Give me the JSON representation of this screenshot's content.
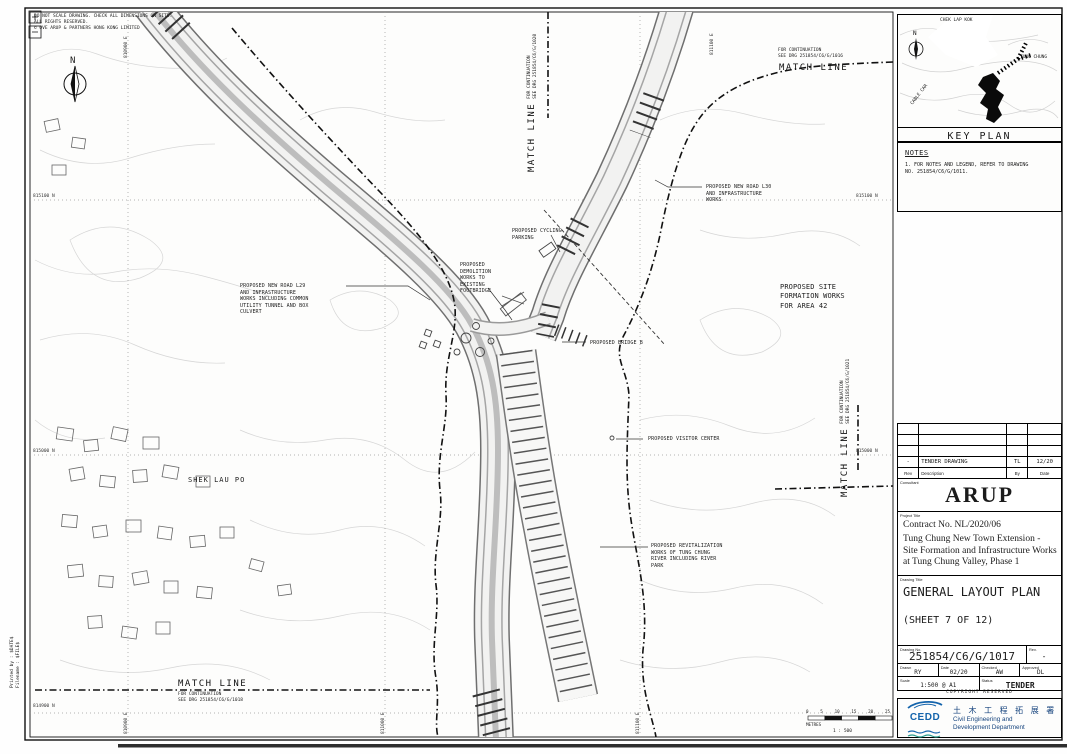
{
  "colors": {
    "line": "#1b1b1b",
    "topo": "#d4d4d4",
    "road_edge": "#777777",
    "accent_blue": "#16447e",
    "logo_blue": "#1464ac",
    "logo_teal": "#2a9d8f"
  },
  "map": {
    "corner_notes": "DO NOT SCALE DRAWING. CHECK ALL DIMENSIONS ON SITE.\nALL RIGHTS RESERVED.\n© OVE ARUP & PARTNERS HONG KONG LIMITED",
    "north_label": "N",
    "place_label": "SHEK LAU PO",
    "match_lines": {
      "top_right": {
        "title": "MATCH LINE",
        "note": "FOR CONTINUATION\nSEE DRG 251854/C6/G/1016"
      },
      "top_center": {
        "title": "MATCH LINE",
        "note": "FOR CONTINUATION\nSEE DRG 251854/C6/G/1020"
      },
      "right": {
        "title": "MATCH LINE",
        "note": "FOR CONTINUATION\nSEE DRG 251854/C6/G/1021"
      },
      "bottom_left": {
        "title": "MATCH LINE",
        "note": "FOR CONTINUATION\nSEE DRG 251854/C6/G/1018"
      }
    },
    "annotations": [
      {
        "text": "PROPOSED NEW ROAD L29\nAND INFRASTRUCTURE\nWORKS INCLUDING COMMON\nUTILITY TUNNEL AND BOX\nCULVERT"
      },
      {
        "text": "PROPOSED NEW ROAD L30\nAND INFRASTRUCTURE\nWORKS"
      },
      {
        "text": "PROPOSED CYCLING\nPARKING"
      },
      {
        "text": "PROPOSED\nDEMOLITION\nWORKS TO\nEXISTING\nFOOTBRIDGE"
      },
      {
        "text": "PROPOSED BRIDGE B"
      },
      {
        "text": "PROPOSED SITE\nFORMATION WORKS\nFOR AREA 42"
      },
      {
        "text": "PROPOSED VISITOR CENTER"
      },
      {
        "text": "PROPOSED REVITALIZATION\nWORKS OF TUNG CHUNG\nRIVER INCLUDING RIVER\nPARK"
      }
    ],
    "grid": {
      "northings": [
        "815100 N",
        "815000 N",
        "814900 N"
      ],
      "eastings": [
        "810900 E",
        "811000 E",
        "811100 E"
      ]
    },
    "scale_bar": {
      "ticks": [
        "0",
        "5",
        "10",
        "15",
        "20",
        "25"
      ],
      "unit": "METRES",
      "ratio": "1 : 500"
    }
  },
  "key_plan": {
    "title": "KEY PLAN",
    "labels": {
      "airport": "CHEK LAP KOK",
      "town": "TUNG CHUNG",
      "cable_car": "CABLE CAR"
    }
  },
  "notes_panel": {
    "title": "NOTES",
    "item_1": "1. FOR NOTES AND LEGEND, REFER TO DRAWING\n    NO. 251854/C6/G/1011."
  },
  "title_block": {
    "revision_table": {
      "headers": {
        "rev": "Rev",
        "description": "Description",
        "by": "By",
        "date": "Date"
      },
      "row": {
        "rev": "-",
        "description": "TENDER DRAWING",
        "by": "TL",
        "date": "12/20"
      }
    },
    "consultant_label": "Consultant",
    "consultant_name": "ARUP",
    "project_label": "Project Title",
    "contract_no": "Contract No. NL/2020/06",
    "project_title": "Tung Chung New Town Extension -\nSite Formation and Infrastructure Works\nat Tung Chung Valley, Phase 1",
    "drawing_title_label": "Drawing Title",
    "drawing_title": "GENERAL LAYOUT PLAN",
    "sheet_label": "(SHEET 7 OF 12)",
    "drawing_no_label": "Drawing No.",
    "drawing_no": "251854/C6/G/1017",
    "rev_label": "Rev.",
    "rev_value": "-",
    "drawn_label": "Drawn",
    "drawn": "RY",
    "date_label": "Date",
    "date": "02/20",
    "checked_label": "Checked",
    "checked": "AW",
    "approved_label": "Approved",
    "approved": "DL",
    "scale_label": "Scale",
    "scale": "1:500 @ A1",
    "status_label": "Status",
    "status": "TENDER",
    "copyright": "COPYRIGHT RESERVED"
  },
  "cedd": {
    "logo_text": "CEDD",
    "chinese": "土 木 工 程 拓 展 署",
    "english": "Civil Engineering and\nDevelopment Department"
  },
  "plot_stamp": {
    "printed_by": "Printed by :  $DATE$",
    "filename": "Filename :  $FILE$"
  }
}
